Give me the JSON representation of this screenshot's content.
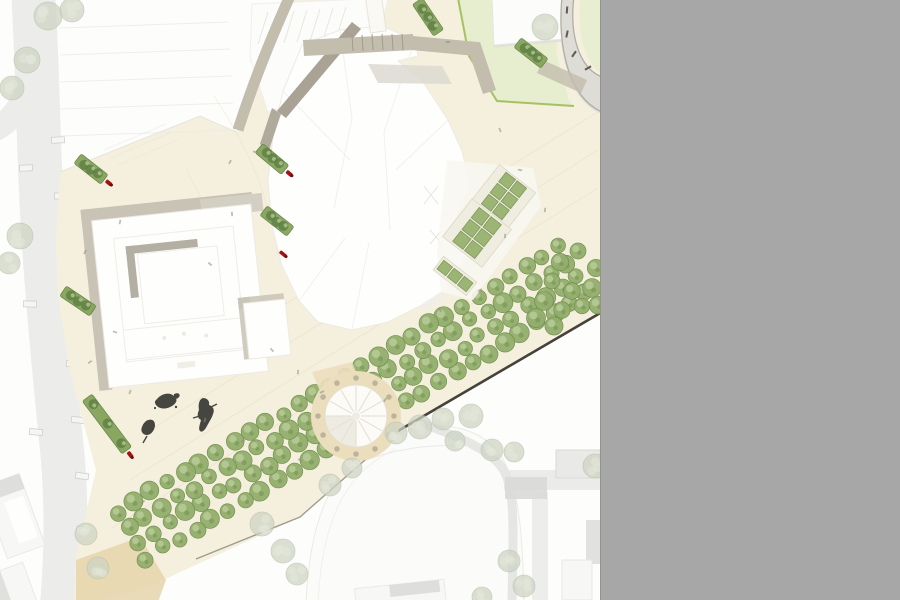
{
  "canvas": {
    "width": 900,
    "height": 600
  },
  "side_panel": {
    "x": 600,
    "width": 300,
    "color": "#a7a7a7",
    "edge_color": "#96938e"
  },
  "palette": {
    "context_bg": "#fdfdfc",
    "context_road": "#ececea",
    "context_building": "#f7f7f5",
    "context_roof": "#d9d9d7",
    "context_path": "#e6e6e4",
    "context_tree_fill": "#cdd4c3",
    "context_tree_edge": "#b8c1ab",
    "context_tree_hi": "#e3e8da",
    "plaza": "#f5efdd",
    "plaza_joint": "#eae1c8",
    "plaza_tick": "#8f8b80",
    "path_taupe": "#c3bdae",
    "taupe_dark": "#a9a295",
    "stair_line": "#a19b8e",
    "shadow_light": "#dcd9d1",
    "building_white": "#fefefd",
    "building_edge": "#eceae3",
    "fold_line": "#f2f0ea",
    "museum_shadow": "#c8c3b5",
    "museum_inner": "#b3afa3",
    "courtyard_line": "#efede6",
    "lawn": "#e7edcf",
    "lawn_line": "#a6c162",
    "road": "#dedcd7",
    "road_curb": "#b2aea5",
    "road_dash": "#5f5a52",
    "bay_line": "#d0d0cd",
    "hedge": "#85a45c",
    "hedge_dark": "#5e7f43",
    "hedge_light": "#a9c089",
    "bed_frame": "#efece0",
    "bed_green": "#9cb474",
    "bed_green_dark": "#7e9a5c",
    "bosque": "#93ae6c",
    "bosque_dark": "#6f8d4f",
    "bosque_light": "#bccf9d",
    "wall_dark": "#46423a",
    "wall_soft": "#8a8678",
    "bank_tan": "#e5d5ab",
    "circle_pad": "#ebdebd",
    "circle_dot": "#b5ad97",
    "circle_white": "#fcfbf7",
    "circle_line": "#e2ded0",
    "red": "#a21212",
    "red_dark": "#6e0b0b",
    "sketch": "#2f2f2b"
  },
  "features": {
    "context_trees": [
      [
        48,
        16,
        14
      ],
      [
        72,
        10,
        12
      ],
      [
        27,
        60,
        13
      ],
      [
        12,
        88,
        12
      ],
      [
        20,
        236,
        13
      ],
      [
        9,
        263,
        11
      ],
      [
        86,
        534,
        11
      ],
      [
        98,
        568,
        11
      ],
      [
        262,
        524,
        12
      ],
      [
        283,
        551,
        12
      ],
      [
        297,
        574,
        11
      ],
      [
        396,
        433,
        11
      ],
      [
        420,
        427,
        12
      ],
      [
        443,
        419,
        11
      ],
      [
        471,
        416,
        12
      ],
      [
        455,
        441,
        10
      ],
      [
        492,
        450,
        11
      ],
      [
        514,
        452,
        10
      ],
      [
        509,
        561,
        11
      ],
      [
        524,
        586,
        11
      ],
      [
        595,
        466,
        12
      ],
      [
        545,
        27,
        13
      ],
      [
        482,
        597,
        10
      ],
      [
        330,
        485,
        11
      ],
      [
        352,
        468,
        10
      ]
    ],
    "road_bays": [
      [
        58,
        140,
        -3
      ],
      [
        61,
        196,
        -1
      ],
      [
        64,
        252,
        1
      ],
      [
        68,
        308,
        3
      ],
      [
        73,
        364,
        5
      ],
      [
        78,
        420,
        7
      ],
      [
        82,
        476,
        8
      ],
      [
        83,
        530,
        9
      ],
      [
        26,
        168,
        -3
      ],
      [
        30,
        304,
        2
      ],
      [
        36,
        432,
        6
      ]
    ],
    "hedges": [
      {
        "x": 272,
        "y": 159,
        "a": 40,
        "l": 34,
        "red": true
      },
      {
        "x": 277,
        "y": 221,
        "a": 38,
        "l": 34,
        "red": false
      },
      {
        "x": 91,
        "y": 169,
        "a": 38,
        "l": 34,
        "red": true
      },
      {
        "x": 78,
        "y": 301,
        "a": 34,
        "l": 36,
        "red": false
      },
      {
        "x": 107,
        "y": 424,
        "a": 53,
        "l": 66,
        "red": true
      },
      {
        "x": 428,
        "y": 17,
        "a": 56,
        "l": 38,
        "red": false
      },
      {
        "x": 531,
        "y": 53,
        "a": 38,
        "l": 34,
        "red": false
      }
    ],
    "red_marks": [
      [
        283,
        254,
        40
      ]
    ],
    "planting_beds": [
      {
        "cx": 504,
        "cy": 196,
        "a": 38,
        "cols": 2,
        "rows": 3,
        "cell": 12,
        "gap": 2,
        "fw": 46,
        "fh": 44
      },
      {
        "cx": 477,
        "cy": 233,
        "a": 38,
        "cols": 2,
        "rows": 3,
        "cell": 13,
        "gap": 2,
        "fw": 50,
        "fh": 48
      },
      {
        "cx": 455,
        "cy": 276,
        "a": 38,
        "cols": 3,
        "rows": 1,
        "cell": 11,
        "gap": 2,
        "fw": 42,
        "fh": 17
      }
    ],
    "bosque": {
      "start": [
        588,
        296
      ],
      "end": [
        136,
        568
      ],
      "rows": 4,
      "row_gap": 18,
      "spacing": 19,
      "extra": [
        [
          560,
          262
        ],
        [
          578,
          251
        ],
        [
          596,
          268
        ],
        [
          552,
          281
        ],
        [
          572,
          291
        ],
        [
          592,
          288
        ],
        [
          544,
          301
        ],
        [
          562,
          310
        ],
        [
          582,
          306
        ],
        [
          598,
          305
        ],
        [
          536,
          318
        ],
        [
          554,
          326
        ]
      ]
    },
    "circle_feature": {
      "cx": 356,
      "cy": 416,
      "pad_r": 45,
      "dot_ring_r": 38,
      "dots": 12,
      "inner_r": 31,
      "spokes": 12
    },
    "plaza_ticks": [
      [
        255,
        152
      ],
      [
        232,
        214
      ],
      [
        210,
        264
      ],
      [
        272,
        350
      ],
      [
        298,
        372
      ],
      [
        322,
        392
      ],
      [
        418,
        352
      ],
      [
        452,
        336
      ],
      [
        205,
        420
      ],
      [
        243,
        441
      ],
      [
        262,
        470
      ],
      [
        300,
        460
      ],
      [
        172,
        482
      ],
      [
        143,
        502
      ],
      [
        430,
        20
      ],
      [
        448,
        42
      ],
      [
        500,
        130
      ],
      [
        520,
        170
      ],
      [
        545,
        210
      ],
      [
        560,
        240
      ],
      [
        505,
        236
      ],
      [
        480,
        290
      ],
      [
        440,
        310
      ],
      [
        385,
        400
      ],
      [
        120,
        222
      ],
      [
        85,
        252
      ],
      [
        115,
        332
      ],
      [
        90,
        362
      ],
      [
        130,
        392
      ],
      [
        230,
        162
      ]
    ]
  }
}
